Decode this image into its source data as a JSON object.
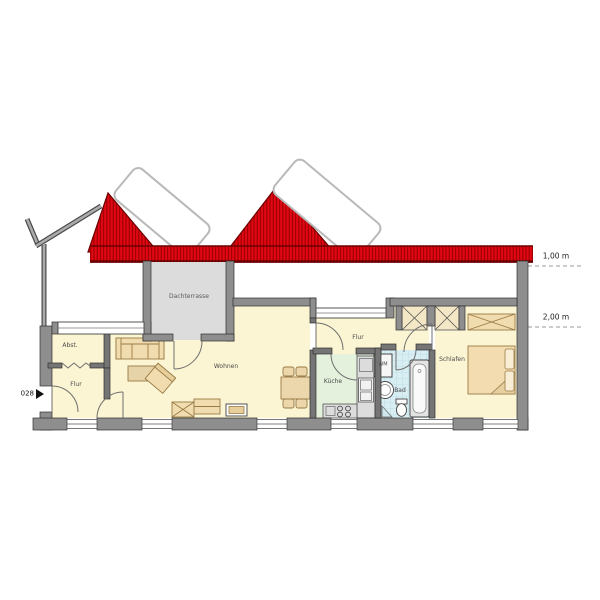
{
  "plan": {
    "unit_marker": "028",
    "height_lines": [
      {
        "label": "1,00 m"
      },
      {
        "label": "2,00 m"
      }
    ],
    "rooms": [
      {
        "id": "dachterrasse",
        "label": "Dachterrasse"
      },
      {
        "id": "abstellraum",
        "label": "Abst."
      },
      {
        "id": "flur_links",
        "label": "Flur"
      },
      {
        "id": "wohnen",
        "label": "Wohnen"
      },
      {
        "id": "flur_rechts",
        "label": "Flur"
      },
      {
        "id": "kueche",
        "label": "Küche"
      },
      {
        "id": "bad",
        "label": "Bad"
      },
      {
        "id": "schlafen",
        "label": "Schlafen"
      }
    ],
    "fixtures": [
      {
        "id": "waschmaschine",
        "label": "WM"
      }
    ]
  },
  "colors": {
    "label_color": "#4a4a4a",
    "roof_red": "#e30613",
    "roof_hatch_dark": "#8f0000",
    "roof_edge_dark": "#6b0000",
    "wall_gray": "#8e8e8e",
    "wall_outline": "#2f2f2f",
    "room_yellow": "#fbf5d3",
    "kitchen_green": "#e4f1dc",
    "bath_blue": "#d9eef3",
    "terrace_gray": "#dcdcdc",
    "furniture_tan": "#f0dcae"
  }
}
